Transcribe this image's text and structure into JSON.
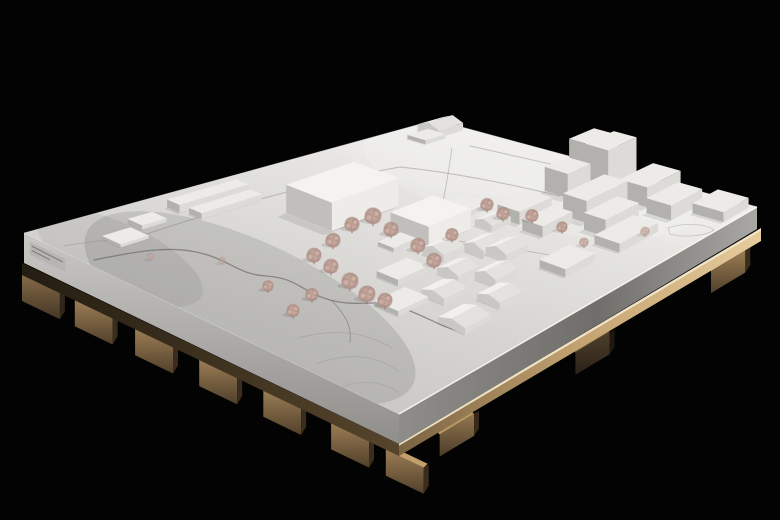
{
  "meta": {
    "alt": "Photograph of a white architectural massing model of a town site, mounted on a plywood board with wooden battens, lit against a black background",
    "description": "White monochrome site model: two large new halls in the centre surrounded by dusty-pink wire trees, a dense cluster of taller blocks on the right, small gabled village houses in front, engraved roads and a winding stream, all on a thick white board resting on a plywood base with protruding wooden feet."
  },
  "colors": {
    "background": "#030303",
    "board_top_dark": "#c2c1be",
    "board_top_mid": "#d7d6d3",
    "board_top_light": "#e9e8e5",
    "board_top_lightest": "#f3f2ef",
    "edge_highlight": "#fbf9f2",
    "fascia_left_top": "#c9c8c5",
    "fascia_left_bottom": "#8f8e8b",
    "fascia_right_near": "#8e8d8a",
    "fascia_right_mid": "#6f6e6b",
    "fascia_right_far": "#a9a8a4",
    "plywood_dark": "#7a6342",
    "plywood_mid": "#c4a371",
    "plywood_light": "#e6cb9c",
    "plywood_highlight": "#f4e8cb",
    "plyleft_dark": "#241d12",
    "plyleft_light": "#57452c",
    "foot_top": "#c29f6c",
    "foot_front_top": "#9b7d54",
    "foot_front_bottom": "#51402b",
    "foot_end": "#3a2d1d",
    "roof": "#ecebe7",
    "roof_bright": "#f4f3f0",
    "wall_front": "#dcdbd7",
    "wall_front_bright": "#edece8",
    "wall_side": "#b2b1ae",
    "wall_side_bright": "#c0bfbc",
    "gable": "#c9c8c4",
    "roof_front_house": "#e3e2de",
    "roof_back_house": "#f1f0ed",
    "tree_center": "#d8bcb2",
    "tree_mid": "#c0a198",
    "tree_outer": "#a9897f",
    "tree_trunk": "#87685d",
    "engrave": "#8b8a86",
    "stream": "#676662",
    "shadow_fill": "#101010",
    "plate_face": "#b6b5b2",
    "plate_line": "#6f6e6a"
  },
  "board": {
    "corners": {
      "w": [
        24,
        233
      ],
      "n": [
        435,
        120
      ],
      "e": [
        757,
        207
      ],
      "s": [
        399,
        414
      ]
    },
    "fascia": {
      "w": 30,
      "s": 30,
      "e": 22
    },
    "plywood_h": 12
  },
  "nameplate": {
    "t0": 0.01,
    "t1": 0.105,
    "drop": 7,
    "height": 13,
    "lines": 2
  },
  "scene": {
    "feet": {
      "left": {
        "w": 42,
        "h": 26,
        "t": [
          [
            0.0,
            0.85
          ],
          [
            0.14,
            1
          ],
          [
            0.3,
            1
          ],
          [
            0.47,
            1
          ],
          [
            0.64,
            1
          ],
          [
            0.82,
            1
          ],
          [
            0.965,
            1
          ]
        ]
      },
      "right": {
        "w": 40,
        "h": 22,
        "t": [
          [
            0.1,
            0.95
          ],
          [
            0.48,
            0.5
          ],
          [
            0.86,
            1
          ]
        ]
      }
    },
    "shading": [
      [
        530,
        180,
        170,
        48,
        12,
        "light",
        0.15
      ],
      [
        430,
        152,
        120,
        34,
        14,
        "light",
        0.1
      ],
      [
        250,
        308,
        180,
        66,
        25,
        "dark",
        0.1
      ],
      [
        120,
        258,
        90,
        34,
        25,
        "dark",
        0.06
      ],
      [
        700,
        224,
        70,
        26,
        10,
        "light",
        0.1
      ]
    ],
    "paths": [
      {
        "name": "stream-course",
        "d": "M 94,260 C 138,251 168,246 196,252 C 230,259 236,274 266,276 C 298,278 301,292 330,300 C 360,308 378,298 400,307 C 428,317 442,328 462,331",
        "c": "stream",
        "w": 1.3,
        "o": 0.65
      },
      {
        "name": "stream-branch",
        "d": "M 332,301 C 346,315 352,328 350,342",
        "c": "stream",
        "w": 1,
        "o": 0.45
      },
      {
        "name": "road-upper",
        "d": "M 120,243 C 225,207 320,181 400,167 C 458,173 514,185 560,196",
        "c": "engrave",
        "w": 1,
        "o": 0.5
      },
      {
        "name": "road-back",
        "d": "M 452,148 C 448,176 444,198 440,216",
        "c": "engrave",
        "w": 0.9,
        "o": 0.45
      },
      {
        "name": "road-east",
        "d": "M 470,146 C 560,166 650,186 724,206",
        "c": "engrave",
        "w": 1,
        "o": 0.45
      },
      {
        "name": "road-village",
        "d": "M 452,240 C 500,247 540,252 582,262",
        "c": "engrave",
        "w": 0.9,
        "o": 0.45
      },
      {
        "name": "contour-1",
        "d": "M 298,338 C 334,328 366,332 392,348",
        "c": "engrave",
        "w": 0.8,
        "o": 0.4
      },
      {
        "name": "contour-2",
        "d": "M 316,364 C 348,352 376,355 398,371",
        "c": "engrave",
        "w": 0.8,
        "o": 0.35
      },
      {
        "name": "contour-3",
        "d": "M 338,388 C 362,379 381,381 398,392",
        "c": "engrave",
        "w": 0.8,
        "o": 0.3
      },
      {
        "name": "pond-outline",
        "d": "M 668,228 C 684,222 706,224 714,230 C 706,236 684,238 670,234 Z",
        "c": "engrave",
        "w": 0.8,
        "o": 0.4
      },
      {
        "name": "path-west",
        "d": "M 64,246 C 92,241 112,239 134,242",
        "c": "engrave",
        "w": 0.9,
        "o": 0.4
      }
    ],
    "buildings": [
      {
        "name": "main-hall",
        "type": "box",
        "u": [
          0.45,
          0.62
        ],
        "v": [
          0.22,
          0.35
        ],
        "h": 28,
        "tone": "bright"
      },
      {
        "name": "second-hall",
        "type": "box",
        "u": [
          0.52,
          0.63
        ],
        "v": [
          0.44,
          0.55
        ],
        "h": 20,
        "tone": "bright"
      },
      {
        "name": "north-bar-a",
        "type": "box",
        "u": [
          0.3,
          0.47
        ],
        "v": [
          0.055,
          0.09
        ],
        "h": 8
      },
      {
        "name": "north-bar-b",
        "type": "box",
        "u": [
          0.31,
          0.46
        ],
        "v": [
          0.105,
          0.14
        ],
        "h": 6
      },
      {
        "name": "north-low",
        "type": "box",
        "u": [
          0.19,
          0.25
        ],
        "v": [
          0.07,
          0.11
        ],
        "h": 4
      },
      {
        "name": "west-low",
        "type": "box",
        "u": [
          0.1,
          0.17
        ],
        "v": [
          0.1,
          0.15
        ],
        "h": 3
      },
      {
        "name": "back-house",
        "type": "house",
        "u": [
          0.93,
          0.99
        ],
        "v": [
          0.035,
          0.1
        ],
        "h": 7,
        "ridge": 5
      },
      {
        "name": "back-shed",
        "type": "box",
        "u": [
          0.885,
          0.935
        ],
        "v": [
          0.06,
          0.115
        ],
        "h": 4
      },
      {
        "name": "tower-a",
        "type": "box",
        "u": [
          0.93,
          0.995
        ],
        "v": [
          0.5,
          0.575
        ],
        "h": 36
      },
      {
        "name": "tower-b",
        "type": "box",
        "u": [
          0.9,
          0.975
        ],
        "v": [
          0.585,
          0.655
        ],
        "h": 44
      },
      {
        "name": "tower-c",
        "type": "box",
        "u": [
          0.845,
          0.905
        ],
        "v": [
          0.525,
          0.595
        ],
        "h": 24
      },
      {
        "name": "right-slab-a",
        "type": "box",
        "u": [
          0.78,
          0.89
        ],
        "v": [
          0.655,
          0.725
        ],
        "h": 22
      },
      {
        "name": "right-slab-b",
        "type": "box",
        "u": [
          0.755,
          0.845
        ],
        "v": [
          0.745,
          0.81
        ],
        "h": 17
      },
      {
        "name": "east-block-a",
        "type": "box",
        "u": [
          0.895,
          0.985
        ],
        "v": [
          0.695,
          0.78
        ],
        "h": 20
      },
      {
        "name": "east-block-b",
        "type": "box",
        "u": [
          0.875,
          0.96
        ],
        "v": [
          0.8,
          0.875
        ],
        "h": 15
      },
      {
        "name": "east-block-c",
        "type": "box",
        "u": [
          0.92,
          0.99
        ],
        "v": [
          0.89,
          0.985
        ],
        "h": 10
      },
      {
        "name": "mid-block-a",
        "type": "box",
        "u": [
          0.7,
          0.785
        ],
        "v": [
          0.55,
          0.615
        ],
        "h": 13
      },
      {
        "name": "mid-block-b",
        "type": "box",
        "u": [
          0.685,
          0.765
        ],
        "v": [
          0.64,
          0.7
        ],
        "h": 11
      },
      {
        "name": "south-low-a",
        "type": "box",
        "u": [
          0.72,
          0.825
        ],
        "v": [
          0.815,
          0.89
        ],
        "h": 9
      },
      {
        "name": "south-low-b",
        "type": "box",
        "u": [
          0.585,
          0.665
        ],
        "v": [
          0.8,
          0.875
        ],
        "h": 8
      },
      {
        "name": "terrace",
        "type": "box",
        "u": [
          0.655,
          0.72
        ],
        "v": [
          0.43,
          0.5
        ],
        "h": 5
      },
      {
        "name": "village-house-1",
        "type": "house",
        "u": [
          0.49,
          0.545
        ],
        "v": [
          0.565,
          0.625
        ],
        "h": 7,
        "ridge": 5
      },
      {
        "name": "village-house-2",
        "type": "house",
        "u": [
          0.55,
          0.605
        ],
        "v": [
          0.615,
          0.675
        ],
        "h": 7,
        "ridge": 5
      },
      {
        "name": "village-house-3",
        "type": "house",
        "u": [
          0.445,
          0.5
        ],
        "v": [
          0.655,
          0.715
        ],
        "h": 6,
        "ridge": 5
      },
      {
        "name": "village-house-4",
        "type": "house",
        "u": [
          0.36,
          0.42
        ],
        "v": [
          0.7,
          0.765
        ],
        "h": 6,
        "ridge": 4
      },
      {
        "name": "village-house-5",
        "type": "house",
        "u": [
          0.475,
          0.535
        ],
        "v": [
          0.73,
          0.79
        ],
        "h": 7,
        "ridge": 5
      },
      {
        "name": "village-house-6",
        "type": "house",
        "u": [
          0.415,
          0.475
        ],
        "v": [
          0.8,
          0.865
        ],
        "h": 6,
        "ridge": 4
      },
      {
        "name": "village-house-7",
        "type": "house",
        "u": [
          0.3,
          0.37
        ],
        "v": [
          0.81,
          0.885
        ],
        "h": 6,
        "ridge": 4
      },
      {
        "name": "village-house-8",
        "type": "house",
        "u": [
          0.565,
          0.62
        ],
        "v": [
          0.665,
          0.725
        ],
        "h": 7,
        "ridge": 5
      },
      {
        "name": "village-house-9",
        "type": "house",
        "u": [
          0.645,
          0.695
        ],
        "v": [
          0.545,
          0.595
        ],
        "h": 6,
        "ridge": 4
      },
      {
        "name": "village-box-a",
        "type": "box",
        "u": [
          0.36,
          0.44
        ],
        "v": [
          0.575,
          0.635
        ],
        "h": 6
      },
      {
        "name": "village-box-b",
        "type": "box",
        "u": [
          0.27,
          0.35
        ],
        "v": [
          0.665,
          0.73
        ],
        "h": 5
      },
      {
        "name": "village-shed",
        "type": "box",
        "u": [
          0.46,
          0.52
        ],
        "v": [
          0.47,
          0.515
        ],
        "h": 4
      }
    ],
    "trees": [
      [
        373,
        219,
        9
      ],
      [
        391,
        232,
        8
      ],
      [
        352,
        227,
        8
      ],
      [
        333,
        243,
        8
      ],
      [
        314,
        258,
        8
      ],
      [
        331,
        269,
        8
      ],
      [
        350,
        284,
        9
      ],
      [
        367,
        297,
        9
      ],
      [
        385,
        303,
        8
      ],
      [
        312,
        297,
        7
      ],
      [
        293,
        313,
        7
      ],
      [
        418,
        248,
        8
      ],
      [
        434,
        263,
        8
      ],
      [
        452,
        237,
        7
      ],
      [
        487,
        207,
        7
      ],
      [
        503,
        216,
        7
      ],
      [
        532,
        218,
        7
      ],
      [
        562,
        229,
        6
      ],
      [
        268,
        288,
        6
      ],
      [
        584,
        244,
        5,
        0.8
      ],
      [
        645,
        233,
        5,
        0.7
      ],
      [
        150,
        258,
        4,
        0.6
      ],
      [
        222,
        262,
        4,
        0.5
      ]
    ]
  }
}
